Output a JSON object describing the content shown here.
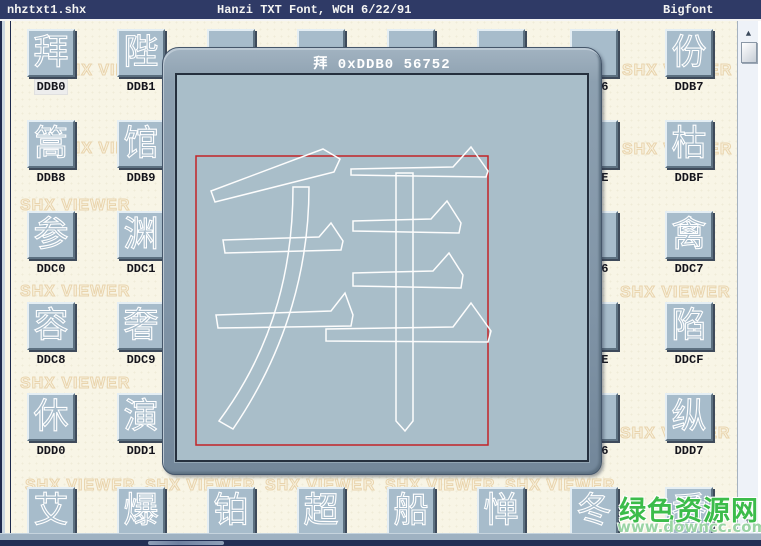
{
  "window": {
    "title_left": "nhztxt1.shx",
    "title_center": "Hanzi TXT Font, WCH 6/22/91",
    "title_right": "Bigfont",
    "glyph_count": "3760"
  },
  "dialog": {
    "title": "拜 0xDDB0 56752",
    "char": "拜",
    "code_hex": "0xDDB0",
    "code_dec": "56752"
  },
  "watermark": {
    "text": "SHX VIEWER",
    "site_name": "绿色资源网",
    "site_url": "www.downcc.com"
  },
  "scrollbar": {
    "up_icon": "▲",
    "down_icon": "▼"
  },
  "grid": {
    "cells": [
      {
        "label": "DDB0",
        "char": "拜",
        "selected": true
      },
      {
        "label": "DDB1",
        "char": "陛",
        "selected": false
      },
      {
        "label": "",
        "char": "",
        "selected": false
      },
      {
        "label": "",
        "char": "",
        "selected": false
      },
      {
        "label": "",
        "char": "",
        "selected": false
      },
      {
        "label": "",
        "char": "",
        "selected": false
      },
      {
        "label": "DDB6",
        "char": "",
        "selected": false
      },
      {
        "label": "DDB7",
        "char": "份",
        "selected": false
      },
      {
        "label": "DDB8",
        "char": "篙",
        "selected": false
      },
      {
        "label": "DDB9",
        "char": "馆",
        "selected": false
      },
      {
        "label": "",
        "char": "",
        "selected": false
      },
      {
        "label": "",
        "char": "",
        "selected": false
      },
      {
        "label": "",
        "char": "",
        "selected": false
      },
      {
        "label": "",
        "char": "",
        "selected": false
      },
      {
        "label": "DDBE",
        "char": "",
        "selected": false
      },
      {
        "label": "DDBF",
        "char": "枯",
        "selected": false
      },
      {
        "label": "DDC0",
        "char": "参",
        "selected": false
      },
      {
        "label": "DDC1",
        "char": "渊",
        "selected": false
      },
      {
        "label": "",
        "char": "",
        "selected": false
      },
      {
        "label": "",
        "char": "",
        "selected": false
      },
      {
        "label": "",
        "char": "",
        "selected": false
      },
      {
        "label": "",
        "char": "",
        "selected": false
      },
      {
        "label": "DDC6",
        "char": "",
        "selected": false
      },
      {
        "label": "DDC7",
        "char": "禽",
        "selected": false
      },
      {
        "label": "DDC8",
        "char": "容",
        "selected": false
      },
      {
        "label": "DDC9",
        "char": "奢",
        "selected": false
      },
      {
        "label": "",
        "char": "",
        "selected": false
      },
      {
        "label": "",
        "char": "",
        "selected": false
      },
      {
        "label": "",
        "char": "",
        "selected": false
      },
      {
        "label": "",
        "char": "",
        "selected": false
      },
      {
        "label": "DDCE",
        "char": "",
        "selected": false
      },
      {
        "label": "DDCF",
        "char": "陷",
        "selected": false
      },
      {
        "label": "DDD0",
        "char": "休",
        "selected": false
      },
      {
        "label": "DDD1",
        "char": "演",
        "selected": false
      },
      {
        "label": "",
        "char": "",
        "selected": false
      },
      {
        "label": "",
        "char": "",
        "selected": false
      },
      {
        "label": "",
        "char": "",
        "selected": false
      },
      {
        "label": "",
        "char": "",
        "selected": false
      },
      {
        "label": "DDD6",
        "char": "",
        "selected": false
      },
      {
        "label": "DDD7",
        "char": "纵",
        "selected": false
      },
      {
        "label": "",
        "char": "艾",
        "selected": false
      },
      {
        "label": "",
        "char": "爆",
        "selected": false
      },
      {
        "label": "",
        "char": "铂",
        "selected": false
      },
      {
        "label": "",
        "char": "超",
        "selected": false
      },
      {
        "label": "",
        "char": "船",
        "selected": false
      },
      {
        "label": "",
        "char": "惮",
        "selected": false
      },
      {
        "label": "",
        "char": "冬",
        "selected": false
      },
      {
        "label": "",
        "char": "番",
        "selected": false
      }
    ]
  },
  "colors": {
    "titlebar_navy": "#2f3a66",
    "count_segment": "#4f5c88",
    "cream_bg": "#f8f5e6",
    "button_face": "#a7bccb",
    "dialog_frame": "#8296a8",
    "dialog_client": "#a9bec9",
    "bounding_box_red": "#c32427",
    "watermark_tan": "#e9d4ad",
    "site_green": "#3cbc4a"
  }
}
